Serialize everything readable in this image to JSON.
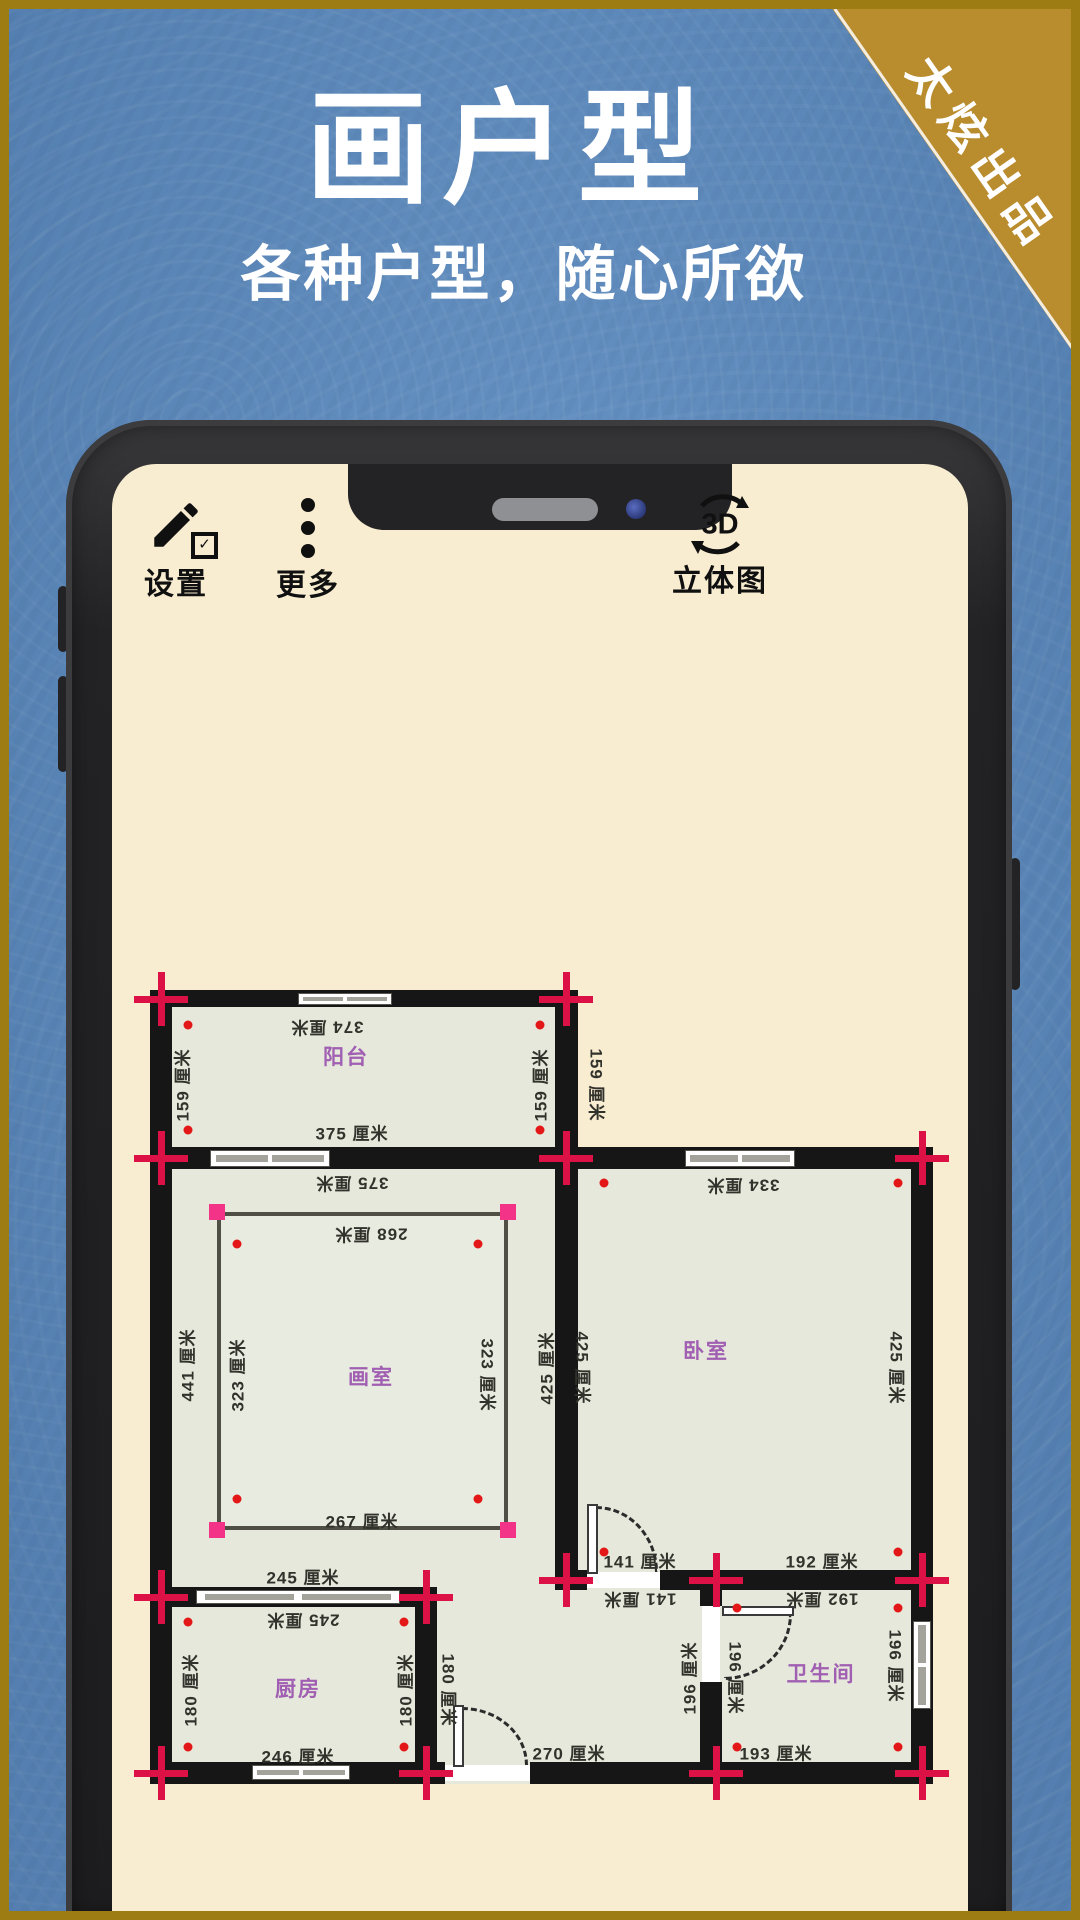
{
  "banner": {
    "title": "画户型",
    "subtitle": "各种户型，随心所欲",
    "ribbon": "太炫出品"
  },
  "toolbar": {
    "settings": "设置",
    "more": "更多",
    "view3d": "立体图",
    "view3d_icon": "3D"
  },
  "plan": {
    "unit": "厘米",
    "rooms": [
      {
        "name": "阳台",
        "width_cm": 375,
        "depth_cm": 159
      },
      {
        "name": "画室",
        "width_cm": 268,
        "depth_cm": 323
      },
      {
        "name": "卧室",
        "width_cm": 334,
        "depth_cm": 425
      },
      {
        "name": "厨房",
        "width_cm": 245,
        "depth_cm": 180
      },
      {
        "name": "卫生间",
        "width_cm": 193,
        "depth_cm": 196
      }
    ],
    "labels": [
      {
        "t": "374 厘米",
        "x": 327,
        "y": 1029,
        "r": 180,
        "k": "dim"
      },
      {
        "t": "159 厘米",
        "x": 181,
        "y": 1085,
        "r": -90,
        "k": "dim"
      },
      {
        "t": "159 厘米",
        "x": 539,
        "y": 1085,
        "r": -90,
        "k": "dim"
      },
      {
        "t": "159 厘米",
        "x": 598,
        "y": 1085,
        "r": 90,
        "k": "dim"
      },
      {
        "t": "375 厘米",
        "x": 352,
        "y": 1132,
        "r": 0,
        "k": "dim"
      },
      {
        "t": "375 厘米",
        "x": 352,
        "y": 1185,
        "r": 180,
        "k": "dim"
      },
      {
        "t": "334 厘米",
        "x": 743,
        "y": 1187,
        "r": 180,
        "k": "dim"
      },
      {
        "t": "268 厘米",
        "x": 371,
        "y": 1236,
        "r": 180,
        "k": "dim"
      },
      {
        "t": "441 厘米",
        "x": 186,
        "y": 1365,
        "r": -90,
        "k": "dim"
      },
      {
        "t": "323 厘米",
        "x": 236,
        "y": 1375,
        "r": -90,
        "k": "dim"
      },
      {
        "t": "323 厘米",
        "x": 489,
        "y": 1375,
        "r": 90,
        "k": "dim"
      },
      {
        "t": "425 厘米",
        "x": 545,
        "y": 1368,
        "r": -90,
        "k": "dim"
      },
      {
        "t": "425 厘米",
        "x": 584,
        "y": 1368,
        "r": 90,
        "k": "dim"
      },
      {
        "t": "425 厘米",
        "x": 898,
        "y": 1368,
        "r": 90,
        "k": "dim"
      },
      {
        "t": "267 厘米",
        "x": 362,
        "y": 1520,
        "r": 0,
        "k": "dim"
      },
      {
        "t": "141 厘米",
        "x": 640,
        "y": 1560,
        "r": 0,
        "k": "dim"
      },
      {
        "t": "192 厘米",
        "x": 822,
        "y": 1560,
        "r": 0,
        "k": "dim"
      },
      {
        "t": "141 厘米",
        "x": 640,
        "y": 1601,
        "r": 180,
        "k": "dim"
      },
      {
        "t": "192 厘米",
        "x": 822,
        "y": 1601,
        "r": 180,
        "k": "dim"
      },
      {
        "t": "245 厘米",
        "x": 303,
        "y": 1576,
        "r": 0,
        "k": "dim"
      },
      {
        "t": "245 厘米",
        "x": 303,
        "y": 1622,
        "r": 180,
        "k": "dim"
      },
      {
        "t": "180 厘米",
        "x": 189,
        "y": 1690,
        "r": -90,
        "k": "dim"
      },
      {
        "t": "180 厘米",
        "x": 404,
        "y": 1690,
        "r": -90,
        "k": "dim"
      },
      {
        "t": "180 厘米",
        "x": 450,
        "y": 1690,
        "r": 90,
        "k": "dim"
      },
      {
        "t": "196 厘米",
        "x": 688,
        "y": 1678,
        "r": -90,
        "k": "dim"
      },
      {
        "t": "196 厘米",
        "x": 737,
        "y": 1678,
        "r": 90,
        "k": "dim"
      },
      {
        "t": "196 厘米",
        "x": 897,
        "y": 1666,
        "r": 90,
        "k": "dim"
      },
      {
        "t": "246 厘米",
        "x": 298,
        "y": 1755,
        "r": 0,
        "k": "dim"
      },
      {
        "t": "270 厘米",
        "x": 569,
        "y": 1752,
        "r": 0,
        "k": "dim"
      },
      {
        "t": "193 厘米",
        "x": 776,
        "y": 1752,
        "r": 0,
        "k": "dim"
      },
      {
        "t": "阳台",
        "x": 346,
        "y": 1056,
        "r": 0,
        "k": "room"
      },
      {
        "t": "画室",
        "x": 371,
        "y": 1376,
        "r": 0,
        "k": "room"
      },
      {
        "t": "卧室",
        "x": 706,
        "y": 1350,
        "r": 0,
        "k": "room"
      },
      {
        "t": "厨房",
        "x": 298,
        "y": 1688,
        "r": 0,
        "k": "room"
      },
      {
        "t": "卫生间",
        "x": 821,
        "y": 1673,
        "r": 0,
        "k": "room"
      }
    ],
    "crosses": [
      {
        "x": 161,
        "y": 999
      },
      {
        "x": 566,
        "y": 999
      },
      {
        "x": 161,
        "y": 1158
      },
      {
        "x": 566,
        "y": 1158
      },
      {
        "x": 922,
        "y": 1158
      },
      {
        "x": 161,
        "y": 1597
      },
      {
        "x": 426,
        "y": 1597
      },
      {
        "x": 566,
        "y": 1580
      },
      {
        "x": 716,
        "y": 1580
      },
      {
        "x": 922,
        "y": 1580
      },
      {
        "x": 161,
        "y": 1773
      },
      {
        "x": 426,
        "y": 1773
      },
      {
        "x": 716,
        "y": 1773
      },
      {
        "x": 922,
        "y": 1773
      }
    ],
    "dots": [
      {
        "x": 188,
        "y": 1025
      },
      {
        "x": 540,
        "y": 1025
      },
      {
        "x": 188,
        "y": 1130
      },
      {
        "x": 540,
        "y": 1130
      },
      {
        "x": 604,
        "y": 1183
      },
      {
        "x": 898,
        "y": 1183
      },
      {
        "x": 237,
        "y": 1244
      },
      {
        "x": 478,
        "y": 1244
      },
      {
        "x": 237,
        "y": 1499
      },
      {
        "x": 478,
        "y": 1499
      },
      {
        "x": 604,
        "y": 1552
      },
      {
        "x": 898,
        "y": 1552
      },
      {
        "x": 188,
        "y": 1622
      },
      {
        "x": 404,
        "y": 1622
      },
      {
        "x": 188,
        "y": 1747
      },
      {
        "x": 404,
        "y": 1747
      },
      {
        "x": 737,
        "y": 1608
      },
      {
        "x": 898,
        "y": 1608
      },
      {
        "x": 737,
        "y": 1747
      },
      {
        "x": 898,
        "y": 1747
      }
    ]
  },
  "colors": {
    "background": "#5e8dc1",
    "border_gold": "#9d7c13",
    "ribbon_gold": "#b98c2e",
    "screen_cream": "#f9edd1",
    "room_fill": "#e5e8da",
    "wall": "#161616",
    "handle_red": "#dc1145",
    "handle_pink": "#f23387",
    "room_label": "#a05fb2"
  }
}
